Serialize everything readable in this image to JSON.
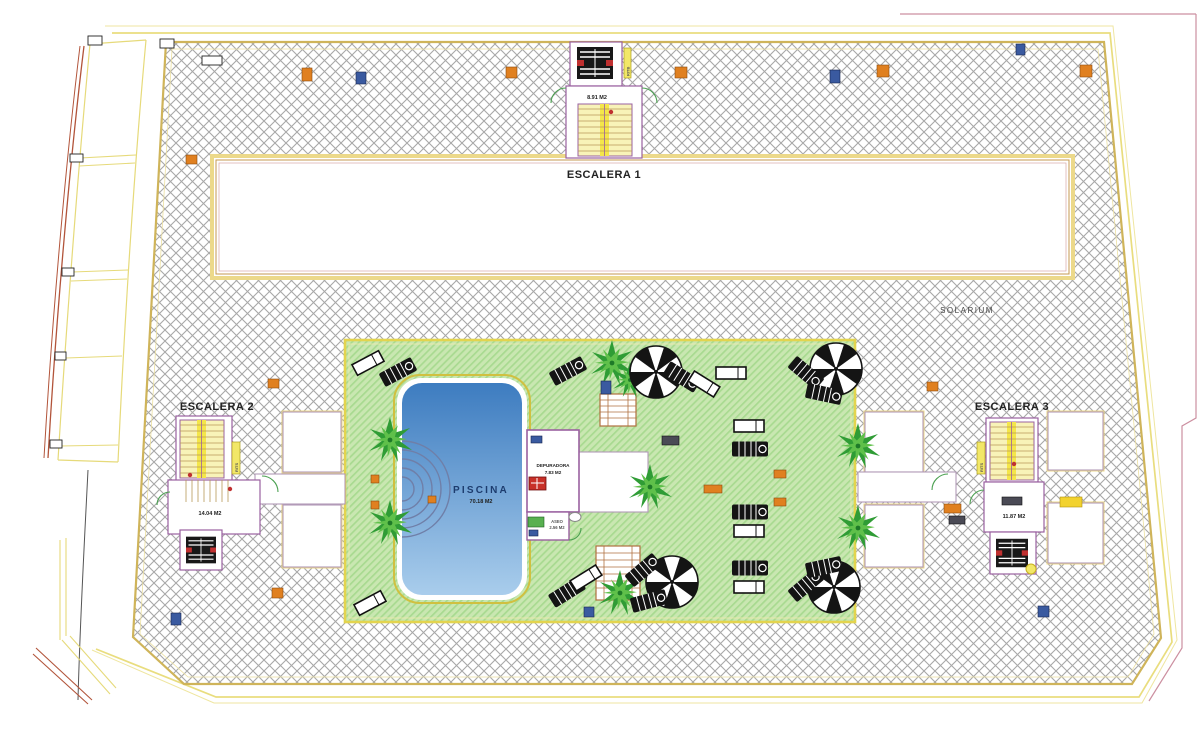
{
  "title": "Planta de cubiertas - Solarium con piscina",
  "labels": {
    "escalera1": {
      "name": "ESCALERA 1",
      "area": "8.91 M2"
    },
    "escalera2": {
      "name": "ESCALERA 2",
      "area": "14.04 M2"
    },
    "escalera3": {
      "name": "ESCALERA 3",
      "area": "11.87 M2"
    },
    "solarium": "SOLARIUM",
    "piscina": {
      "name": "PISCINA",
      "area": "70.18 M2"
    },
    "depuradora": {
      "name": "DEPURADORA",
      "area": "7.83 M2"
    },
    "aseo": {
      "name": "ASEO",
      "area": "2.56 M2"
    },
    "rits": "RITS",
    "ritb": "RITB"
  },
  "colors": {
    "paving_hatch_line": "#a8a8a8",
    "deck_border": "#cfb45a",
    "lawn_base": "#c9e7b1",
    "lawn_stripe": "#a8da90",
    "lawn_border": "#e3d44e",
    "pool_top": "#3d7cc0",
    "pool_bottom": "#a9cdec",
    "pool_text": "#1d3c6e",
    "wall_purple": "#9a60a0",
    "stair_fill": "#f8f3b8",
    "stair_stripe": "#f4e64a",
    "boundary_yellow": "#e9dd7e",
    "boundary_red": "#b2543a",
    "badge_orange": "#e08020",
    "badge_blue": "#3a5aa0",
    "door_green": "#4aa050"
  }
}
